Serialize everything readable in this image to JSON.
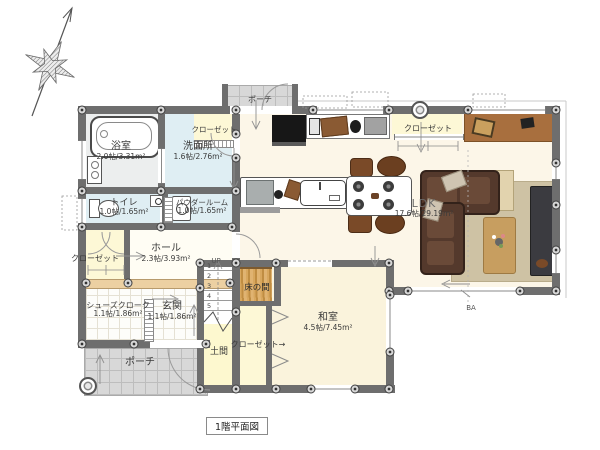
{
  "title": "1階平面図",
  "rooms": {
    "bath": {
      "name": "浴室",
      "size": "2.0帖/3.31m²"
    },
    "washroom": {
      "name": "洗面所",
      "size": "1.6帖/2.76m²"
    },
    "toilet": {
      "name": "トイレ",
      "size": "1.0帖/1.65m²"
    },
    "powder_room": {
      "name": "パウダールーム",
      "size": "1.0帖/1.65m²"
    },
    "hall": {
      "name": "ホール",
      "size": "2.3帖/3.93m²"
    },
    "shoes_cloak": {
      "name": "シューズクローク",
      "size": "1.1帖/1.86m²"
    },
    "entrance": {
      "name": "玄関",
      "size": "1.1帖/1.86m²"
    },
    "ldk": {
      "name": "LDK",
      "size": "17.6帖/29.19m²"
    },
    "washitsu": {
      "name": "和室",
      "size": "4.5帖/7.45m²"
    },
    "doma": {
      "name": "土間"
    },
    "tokonoma": {
      "name": "床の間"
    },
    "porch_top": {
      "name": "ポーチ"
    },
    "porch_bottom": {
      "name": "ポーチ"
    },
    "closet_washroom": {
      "name": "クローゼット"
    },
    "closet_hall": {
      "name": "クローゼット"
    },
    "closet_washitsu": {
      "name": "クローゼット"
    },
    "closet_ldk": {
      "name": "クローゼット"
    }
  },
  "stairs": {
    "up": "UP",
    "steps": [
      "1",
      "2",
      "3",
      "4",
      "5"
    ]
  },
  "annotations": {
    "ba": "BA",
    "arrow_right": "→"
  },
  "colors": {
    "wall": "#6e6e6e",
    "water_room": "#dfeef3",
    "closet_yellow": "#fdf8d6",
    "ldk_floor": "#fcf6e8",
    "washitsu_floor": "#faf3dc",
    "porch": "#d8d8d8",
    "tan_wall": "#ecd0a2",
    "wood": "#c89a50",
    "sofa": "#54392c",
    "desk": "#a86f3e"
  }
}
